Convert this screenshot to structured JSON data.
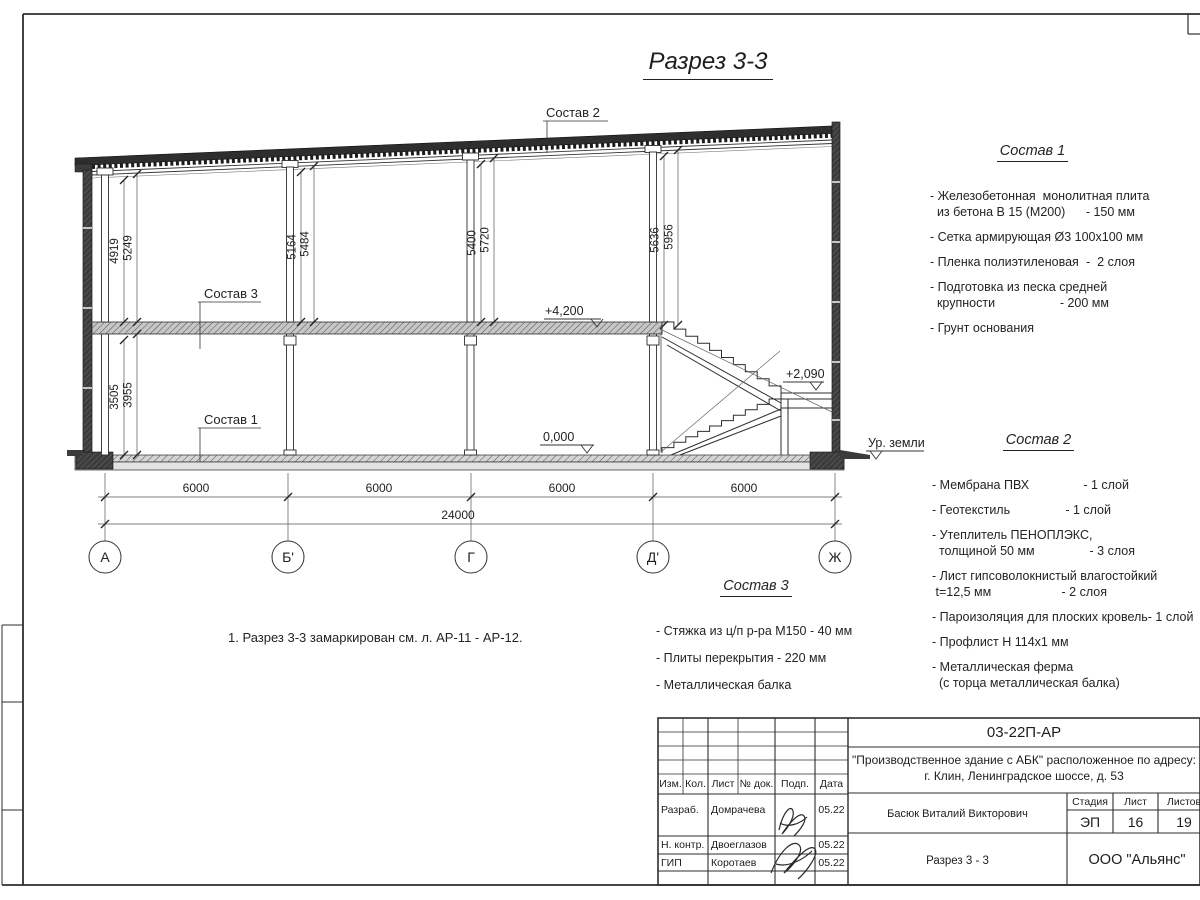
{
  "page": {
    "title": "Разрез 3-3",
    "note": "1. Разрез 3-3 замаркирован см. л. АР-11 - АР-12."
  },
  "section": {
    "labels": {
      "sostav1": "Состав 1",
      "sostav2": "Состав 2",
      "sostav3": "Состав 3"
    },
    "elevations": {
      "floor2": "+4,200",
      "ground": "0,000",
      "landing": "+2,090",
      "ground_level": "Ур. земли"
    },
    "dims": {
      "upper": [
        [
          "4919",
          "5249"
        ],
        [
          "5164",
          "5484"
        ],
        [
          "5400",
          "5720"
        ],
        [
          "5636",
          "5956"
        ]
      ],
      "lower": [
        "3505",
        "3955"
      ],
      "spans": [
        "6000",
        "6000",
        "6000",
        "6000"
      ],
      "total": "24000"
    },
    "axes": [
      "А",
      "Б'",
      "Г",
      "Д'",
      "Ж"
    ]
  },
  "compositions": [
    {
      "title": "Состав 1",
      "lines": [
        {
          "l": "- Железобетонная  монолитная плита",
          "r": ""
        },
        {
          "l": "  из бетона В 15 (М200)",
          "r": "- 150 мм"
        },
        {
          "l": "- Сетка армирующая Ø3 100x100 мм",
          "r": ""
        },
        {
          "l": "- Пленка полиэтиленовая",
          "r": "-  2 слоя"
        },
        {
          "l": "- Подготовка из песка средней",
          "r": ""
        },
        {
          "l": "  крупности",
          "r": "- 200 мм"
        },
        {
          "l": "- Грунт основания",
          "r": ""
        }
      ]
    },
    {
      "title": "Состав 2",
      "lines": [
        {
          "l": "- Мембрана ПВХ",
          "r": "- 1 слой"
        },
        {
          "l": "- Геотекстиль",
          "r": "- 1 слой"
        },
        {
          "l": "- Утеплитель ПЕНОПЛЭКС,",
          "r": ""
        },
        {
          "l": "  толщиной 50 мм",
          "r": "- 3 слоя"
        },
        {
          "l": "- Лист гипсоволокнистый влагостойкий",
          "r": ""
        },
        {
          "l": " t=12,5 мм",
          "r": "- 2 слоя"
        },
        {
          "l": "- Пароизоляция для плоских кровель",
          "r": "- 1 слой"
        },
        {
          "l": "- Профлист Н 114x1 мм",
          "r": ""
        },
        {
          "l": "- Металлическая ферма",
          "r": ""
        },
        {
          "l": "  (с торца металлическая балка)",
          "r": ""
        }
      ]
    },
    {
      "title": "Состав 3",
      "lines": [
        {
          "l": "- Стяжка из ц/п р-ра М150 - 40 мм",
          "r": ""
        },
        {
          "l": "- Плиты перекрытия - 220 мм",
          "r": ""
        },
        {
          "l": "- Металлическая балка",
          "r": ""
        }
      ]
    }
  ],
  "titleblock": {
    "doc_code": "03-22П-АР",
    "project_line1": "\"Производственное здание с АБК\" расположенное по адресу:",
    "project_line2": "г. Клин, Ленинградское шоссе, д. 53",
    "cols": {
      "izm": "Изм.",
      "kol": "Кол.",
      "list": "Лист",
      "ndok": "№ док.",
      "podp": "Подп.",
      "data": "Дата"
    },
    "rows": [
      {
        "role": "Разраб.",
        "name": "Домрачева",
        "date": "05.22"
      },
      {
        "role": "Н. контр.",
        "name": "Двоеглазов",
        "date": "05.22"
      },
      {
        "role": "ГИП",
        "name": "Коротаев",
        "date": "05.22"
      }
    ],
    "chief": "Басюк Виталий Викторович",
    "stage_label": "Стадия",
    "sheet_label": "Лист",
    "sheets_label": "Листов",
    "stage": "ЭП",
    "sheet": "16",
    "sheets": "19",
    "drawing_title": "Разрез 3 - 3",
    "company": "ООО \"Альянс\""
  }
}
